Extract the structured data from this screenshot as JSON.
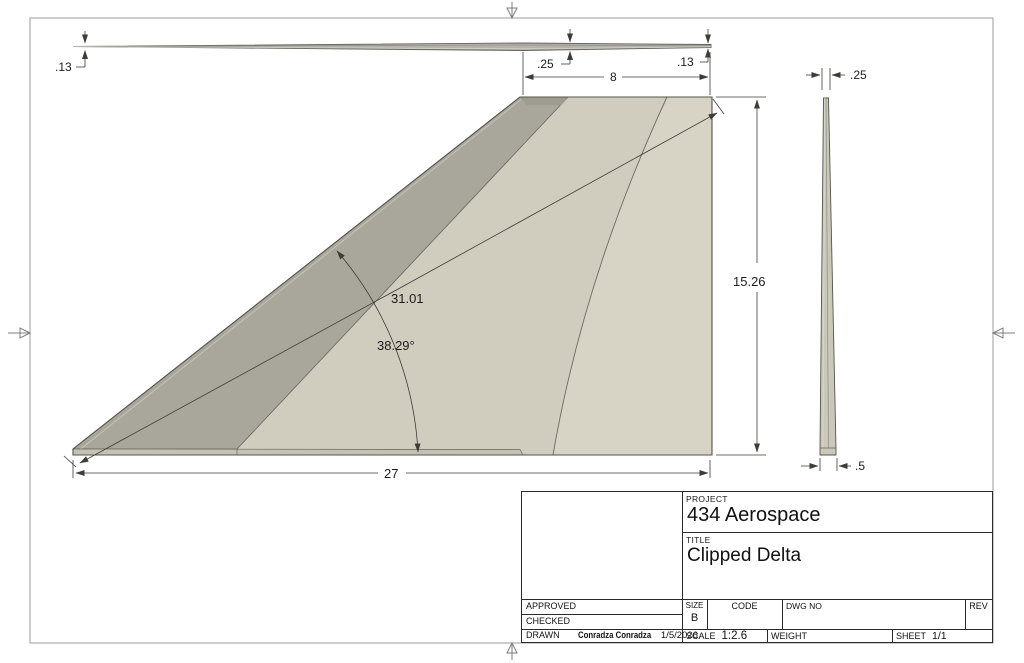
{
  "title_block": {
    "project_label": "PROJECT",
    "project": "434 Aerospace",
    "title_label": "TITLE",
    "title": "Clipped Delta",
    "approved_label": "APPROVED",
    "checked_label": "CHECKED",
    "drawn_label": "DRAWN",
    "drawn_by": "Conradza Conradza",
    "drawn_date": "1/5/2026",
    "size_label": "SIZE",
    "size": "B",
    "code_label": "CODE",
    "dwg_no_label": "DWG NO",
    "rev_label": "REV",
    "scale_label": "SCALE",
    "scale": "1:2.6",
    "weight_label": "WEIGHT",
    "sheet_label": "SHEET",
    "sheet": "1/1"
  },
  "dims": {
    "top_view": {
      "t_left": ".13",
      "t_mid": ".25",
      "chord": "8",
      "t_right": ".13"
    },
    "front_view": {
      "span": "27",
      "height": "15.26",
      "diagonal": "31.01",
      "angle": "38.29°"
    },
    "side_view": {
      "t_top": ".25",
      "t_bottom": ".5"
    }
  },
  "colors": {
    "face": "#d0cdbf",
    "face_light": "#d7d4c6",
    "chamfer": "#a9a79b",
    "chamfer_dark": "#9e9c91",
    "bottom_strip": "#c4c2b5",
    "top_view_fill": "#b6b4aa",
    "side_view_fill": "#cac8ba",
    "edge_line": "#55544c",
    "dim_line": "#3d3c38",
    "sheet_border": "#9b9b9b"
  }
}
